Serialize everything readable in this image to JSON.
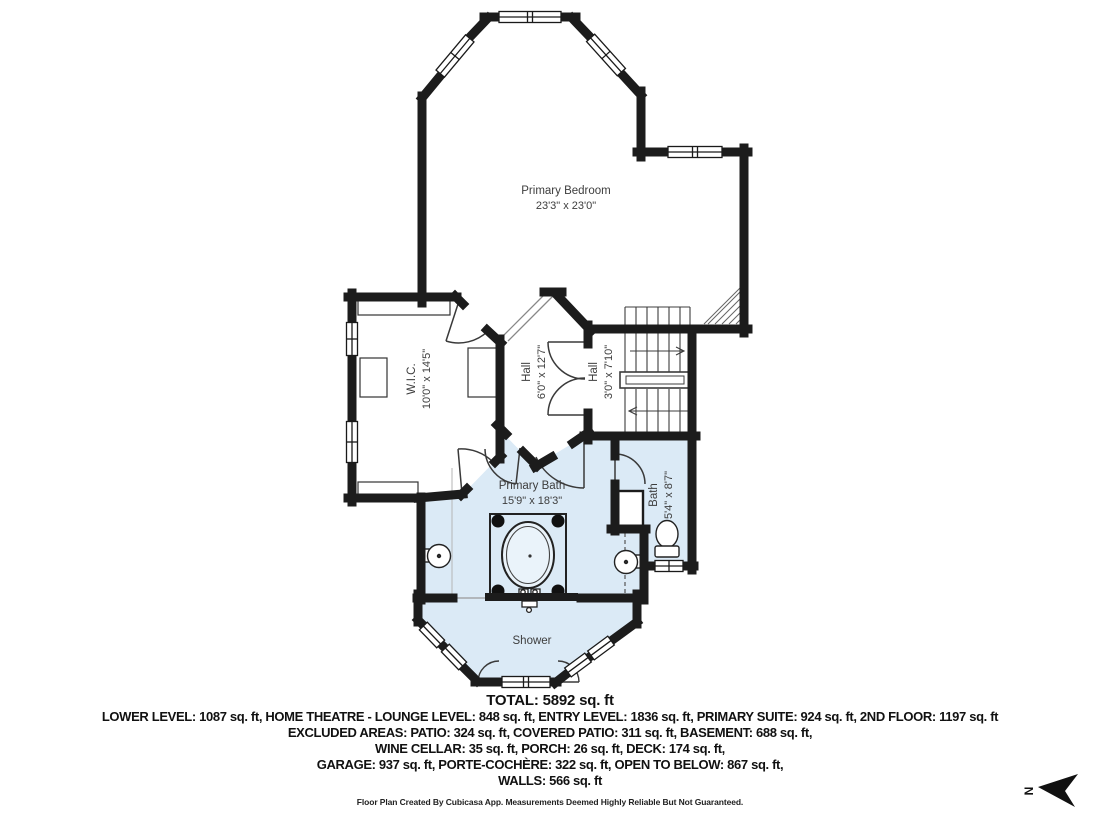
{
  "plan": {
    "rooms": [
      {
        "id": "primary-bedroom",
        "name": "Primary Bedroom",
        "dims": "23'3\" x 23'0\""
      },
      {
        "id": "wic",
        "name": "W.I.C.",
        "dims": "10'0\" x 14'5\""
      },
      {
        "id": "hall-1",
        "name": "Hall",
        "dims": "6'0\" x 12'7\""
      },
      {
        "id": "hall-2",
        "name": "Hall",
        "dims": "3'0\" x 7'10\""
      },
      {
        "id": "primary-bath",
        "name": "Primary Bath",
        "dims": "15'9\" x 18'3\""
      },
      {
        "id": "bath",
        "name": "Bath",
        "dims": "5'4\" x 8'7\""
      },
      {
        "id": "shower",
        "name": "Shower",
        "dims": ""
      }
    ],
    "colors": {
      "wall": "#1c1c1c",
      "bath_fill": "#dbeaf6",
      "background": "#ffffff",
      "label_text": "#3d3d3d"
    }
  },
  "compass": {
    "label": "N"
  },
  "summary": {
    "total": "TOTAL: 5892 sq. ft",
    "lines": [
      "LOWER LEVEL: 1087 sq. ft, HOME THEATRE - LOUNGE LEVEL: 848 sq. ft, ENTRY LEVEL: 1836 sq. ft, PRIMARY SUITE: 924 sq. ft, 2ND FLOOR: 1197 sq. ft",
      "EXCLUDED AREAS: PATIO: 324 sq. ft, COVERED PATIO: 311 sq. ft, BASEMENT: 688 sq. ft,",
      "WINE CELLAR: 35 sq. ft, PORCH: 26 sq. ft, DECK: 174 sq. ft,",
      "GARAGE: 937 sq. ft, PORTE-COCHÈRE: 322 sq. ft, OPEN TO BELOW: 867 sq. ft,",
      "WALLS: 566 sq. ft"
    ],
    "footer": "Floor Plan Created By Cubicasa App. Measurements Deemed Highly Reliable But Not Guaranteed."
  }
}
